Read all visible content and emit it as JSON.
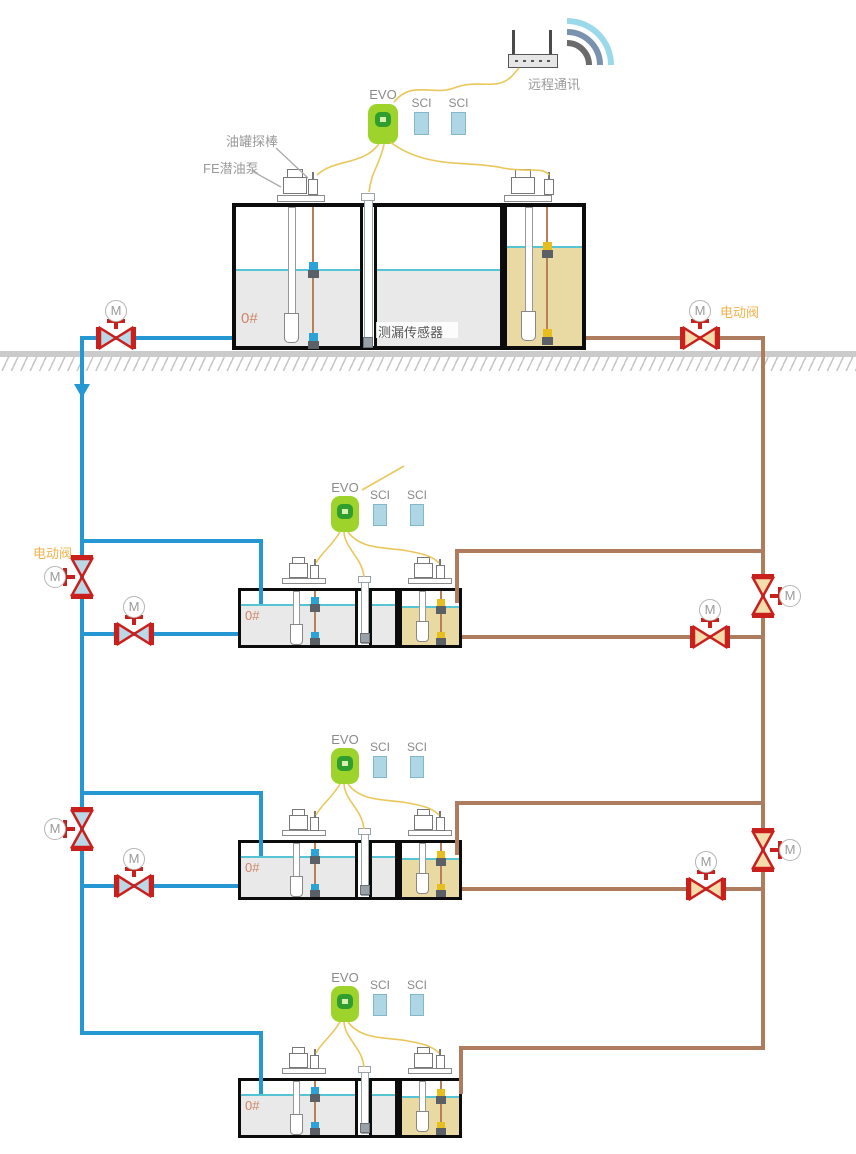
{
  "labels": {
    "remote_comm": "远程通讯",
    "tank_probe": "油罐探棒",
    "submersible_pump": "FE潜油泵",
    "leak_sensor": "测漏传感器",
    "electric_valve": "电动阀",
    "motor": "M",
    "grade": "0#"
  },
  "stations": [
    {
      "name": "station-1",
      "evo": "EVO",
      "sci": [
        "SCI",
        "SCI"
      ],
      "grade": "0#"
    },
    {
      "name": "station-2",
      "evo": "EVO",
      "sci": [
        "SCI",
        "SCI"
      ],
      "grade": "0#"
    },
    {
      "name": "station-3",
      "evo": "EVO",
      "sci": [
        "SCI",
        "SCI"
      ],
      "grade": "0#"
    },
    {
      "name": "station-4",
      "evo": "EVO",
      "sci": [
        "SCI",
        "SCI"
      ],
      "grade": "0#"
    }
  ],
  "colors": {
    "pipe_blue": "#2598d4",
    "pipe_brown": "#ae7d5f",
    "valve_red": "#c9201d",
    "valve_fill_blue": "#b9d9e8",
    "valve_fill_brown": "#f4ddad",
    "wire_yellow": "#e9c75a",
    "evo_green": "#9ed32b",
    "evo_ring": "#2f9e2f",
    "evo_ring_bg": "#d9efb0",
    "sci_blue": "#aed6e4",
    "sci_border": "#84b7cc",
    "liquid_gray": "#e9e9e9",
    "liquid_tan": "#e9d9a2",
    "level_cyan": "#55c5d5",
    "tank_border": "#0c0c0c",
    "label_gray": "#9a9a9a",
    "grade_orange": "#cd8666",
    "evalve_orange": "#f0b24a",
    "wifi_outer": "#9ad9ea",
    "wifi_mid": "#7b92ae",
    "wifi_inner": "#6a6a6a",
    "ground_gray": "#cbcbcb",
    "probe_wire": "#b5805a",
    "node_blue": "#2ba3d8",
    "node_yellow": "#e6bf1e",
    "node_gray": "#5a6066"
  }
}
